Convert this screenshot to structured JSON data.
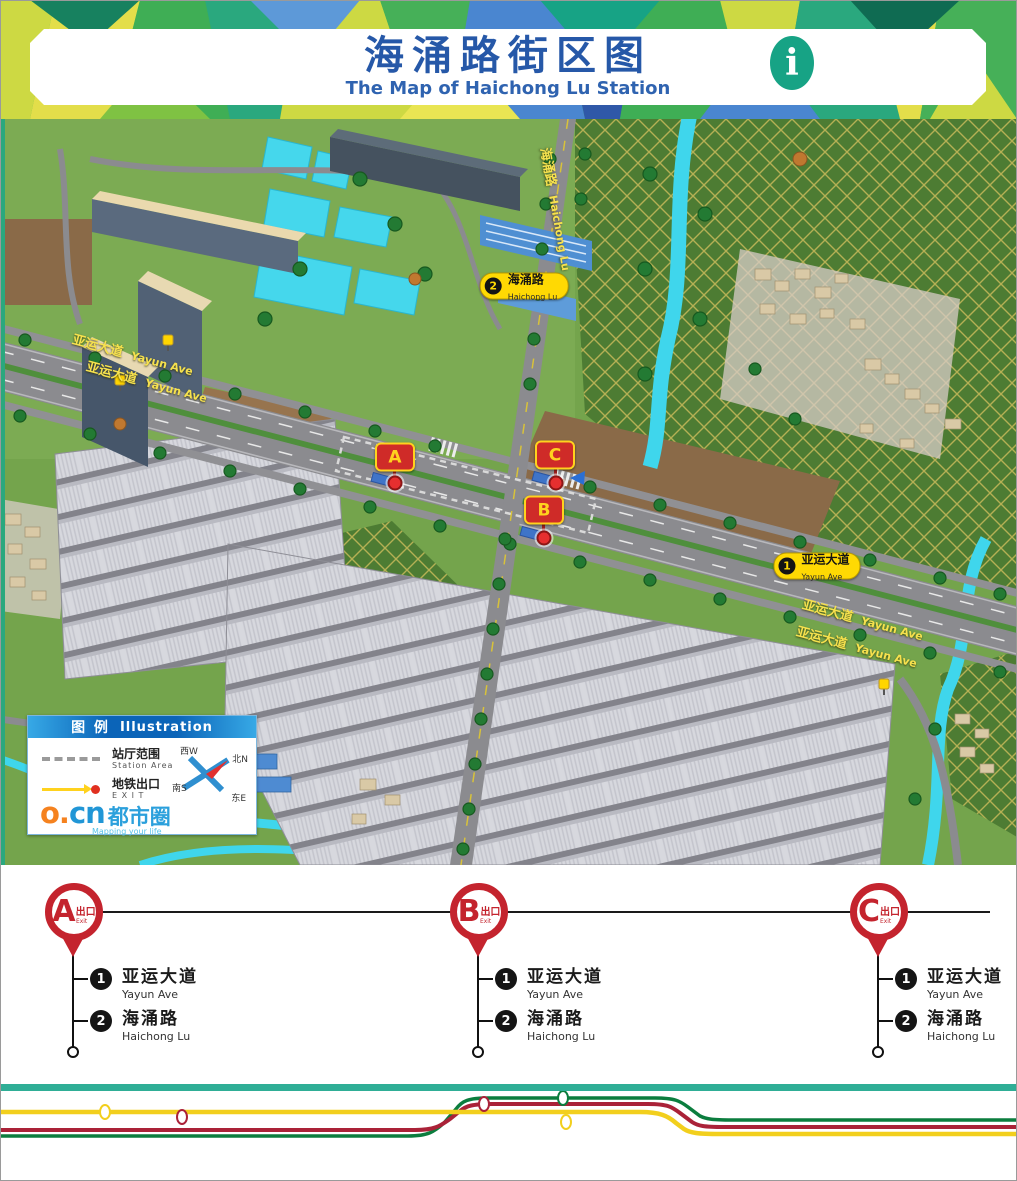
{
  "header": {
    "title": "海涌路街区图",
    "subtitle": "The Map of Haichong Lu Station",
    "info_icon": "i"
  },
  "map": {
    "avenue_label": {
      "zh": "亚运大道",
      "en": "Yayun Ave"
    },
    "street_label": {
      "zh": "海涌路",
      "en": "Haichong Lu"
    },
    "pills": [
      {
        "num": "1",
        "zh": "亚运大道",
        "en": "Yayun Ave"
      },
      {
        "num": "2",
        "zh": "海涌路",
        "en": "Haichong Lu"
      }
    ],
    "exit_markers": [
      {
        "letter": "A"
      },
      {
        "letter": "B"
      },
      {
        "letter": "C"
      }
    ],
    "legend": {
      "title_zh": "图 例",
      "title_en": "Illustration",
      "station_area_zh": "站厅范围",
      "station_area_en": "Station Area",
      "exit_zh": "地铁出口",
      "exit_en": "E X I T",
      "compass": {
        "west": "西W",
        "north": "北N",
        "south": "南S",
        "east": "东E"
      },
      "logo": {
        "latin_o": "o.",
        "latin_cn": "cn",
        "zh": "都市圈",
        "tagline": "Mapping your life"
      }
    }
  },
  "exits": [
    {
      "letter": "A",
      "exit_zh": "出口",
      "exit_en": "Exit",
      "streets": [
        {
          "num": "1",
          "zh": "亚运大道",
          "en": "Yayun Ave"
        },
        {
          "num": "2",
          "zh": "海涌路",
          "en": "Haichong Lu"
        }
      ]
    },
    {
      "letter": "B",
      "exit_zh": "出口",
      "exit_en": "Exit",
      "streets": [
        {
          "num": "1",
          "zh": "亚运大道",
          "en": "Yayun Ave"
        },
        {
          "num": "2",
          "zh": "海涌路",
          "en": "Haichong Lu"
        }
      ]
    },
    {
      "letter": "C",
      "exit_zh": "出口",
      "exit_en": "Exit",
      "streets": [
        {
          "num": "1",
          "zh": "亚运大道",
          "en": "Yayun Ave"
        },
        {
          "num": "2",
          "zh": "海涌路",
          "en": "Haichong Lu"
        }
      ]
    }
  ],
  "colors": {
    "title_blue": "#2658a8",
    "accent_teal": "#2fae96",
    "pin_red": "#c4242e",
    "pill_yellow": "#ffd903",
    "metro_yellow": "#f2cf1d",
    "metro_red": "#aa2238",
    "metro_green": "#0b7d3e"
  }
}
